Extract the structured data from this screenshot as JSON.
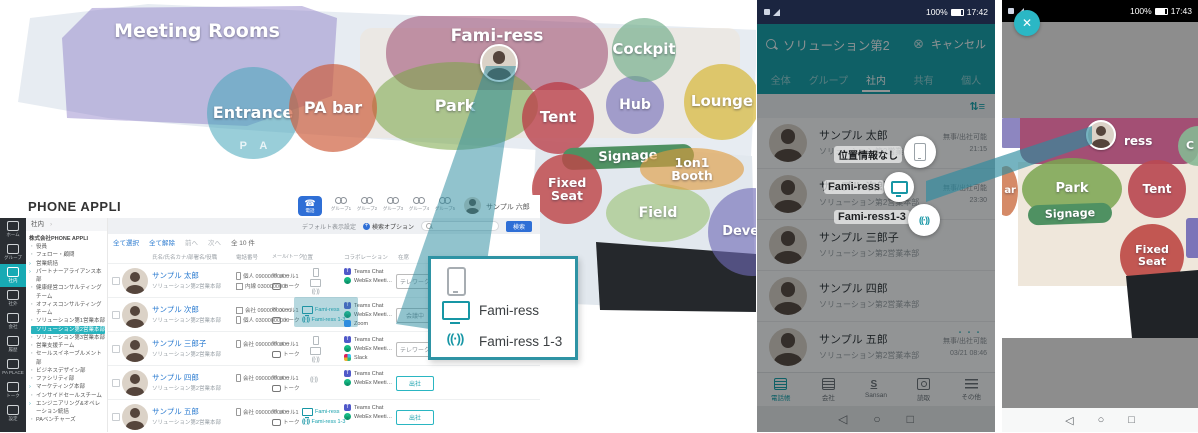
{
  "colors": {
    "teal": "#12a0a9",
    "beam": "#2d8fa3",
    "blue": "#2f6fd6"
  },
  "map": {
    "pa_sign": "P A",
    "zones": {
      "meeting_rooms": "Meeting Rooms",
      "entrance": "Entrance",
      "pa_bar": "PA bar",
      "fami_ress": "Fami-ress",
      "park": "Park",
      "tent": "Tent",
      "hub": "Hub",
      "cockpit": "Cockpit",
      "lounge": "Lounge",
      "signage": "Signage",
      "fixed_seat": "Fixed Seat",
      "field": "Field",
      "booth": "1on1 Booth",
      "develop": "Develop"
    }
  },
  "desktop": {
    "logo": "PHONE APPLI",
    "rail": {
      "home": "ホーム",
      "group": "グループ",
      "internal": "社内",
      "external": "社外",
      "company": "会社",
      "history": "履歴",
      "place": "PA PLACE",
      "talk": "トーク",
      "settings": "設定"
    },
    "header": {
      "phone_button": "電話",
      "groups": [
        "グループ1",
        "グループ2",
        "グループ3",
        "グループ4",
        "グループ5"
      ],
      "user": "サンプル 六郎"
    },
    "searchbar": {
      "default_display": "デフォルト表示設定",
      "search_option": "検索オプション",
      "search_button": "検索"
    },
    "toolbar": {
      "select_all": "全て選択",
      "clear_all": "全て解除",
      "prev": "前へ",
      "next": "次へ",
      "count": "全 10 件"
    },
    "breadcrumb": "社内",
    "tree": {
      "company": "株式会社PHONE APPLI",
      "items": [
        "役員",
        "フェロー・顧問",
        "営業統括",
        "パートナーアライアンス本部",
        "健康経営コンサルティングチーム",
        "オフィスコンサルティングチーム",
        "ソリューション第1営業本部",
        "ソリューション第2営業本部",
        "ソリューション第3営業本部",
        "営業支援チーム",
        "セールスイネーブルメント部",
        "ビジネスデザイン部",
        "ファシリティ部",
        "マーケティング本部",
        "インサイドセールスチーム",
        "エンジニアリング&オペレーション統括",
        "PAベンチャーズ",
        "Phone Appli Global"
      ]
    },
    "table": {
      "columns": [
        "氏名/氏名カナ/部署名/役職",
        "電話番号",
        "メール/トーク",
        "位置",
        "コラボレーション",
        "在席"
      ],
      "rows": [
        {
          "name": "サンプル 太郎",
          "dept": "ソリューション第2営業本部",
          "phone1": "個人 09000000000",
          "phone2": "内線 0300000000",
          "mail": "メール1",
          "talk": "トーク",
          "loc1": "",
          "loc2": "",
          "collab1": "Teams Chat",
          "collab2": "WebEx Meeti…",
          "collab3": "",
          "status": "テレワーク"
        },
        {
          "name": "サンプル 次郎",
          "dept": "ソリューション第2営業本部",
          "phone1": "会社 09000000000",
          "phone2": "個人 03000000000",
          "mail": "メール1",
          "talk": "トーク",
          "loc1": "Fami-ress",
          "loc2": "Fami-ress 1-3",
          "collab1": "Teams Chat",
          "collab2": "WebEx Meeti…",
          "collab3": "Zoom",
          "status": "会議中"
        },
        {
          "name": "サンプル 三郎子",
          "dept": "ソリューション第2営業本部",
          "phone1": "会社 09000000000",
          "phone2": "",
          "mail": "メール1",
          "talk": "トーク",
          "loc1": "",
          "loc2": "",
          "collab1": "Teams Chat",
          "collab2": "WebEx Meeti…",
          "collab3": "Slack",
          "status": "テレワーク"
        },
        {
          "name": "サンプル 四郎",
          "dept": "ソリューション第2営業本部",
          "phone1": "会社 09000000000",
          "phone2": "",
          "mail": "メール1",
          "talk": "トーク",
          "loc1": "",
          "loc2": "",
          "collab1": "Teams Chat",
          "collab2": "WebEx Meeti…",
          "collab3": "",
          "status": "出社"
        },
        {
          "name": "サンプル 五郎",
          "dept": "ソリューション第2営業本部",
          "phone1": "会社 09000000000",
          "phone2": "",
          "mail": "メール1",
          "talk": "トーク",
          "loc1": "Fami-ress",
          "loc2": "Fami-ress 1-3",
          "collab1": "Teams Chat",
          "collab2": "WebEx Meeti…",
          "collab3": "",
          "status": "出社"
        }
      ]
    },
    "callout": {
      "monitor_label": "Fami-ress",
      "beacon_label": "Fami-ress 1-3"
    }
  },
  "phone": {
    "statusbar": {
      "battery": "100%",
      "time": "17:42"
    },
    "search": {
      "query": "ソリューション第2",
      "cancel": "キャンセル"
    },
    "tabs": [
      "全体",
      "グループ",
      "社内",
      "共有",
      "個人"
    ],
    "contacts": [
      {
        "name": "サンプル 太郎",
        "dept": "ソリューション第2営業本部",
        "status": "無事/出社可能",
        "time": "21:15"
      },
      {
        "name": "サンプル 次郎",
        "dept": "ソリューション第2営業本部",
        "status": "無事/出社可能",
        "time": "23:30"
      },
      {
        "name": "サンプル 三郎子",
        "dept": "ソリューション第2営業本部",
        "status": "",
        "time": ""
      },
      {
        "name": "サンプル 四郎",
        "dept": "ソリューション第2営業本部",
        "status": "",
        "time": ""
      },
      {
        "name": "サンプル 五郎",
        "dept": "ソリューション第2営業本部",
        "status": "無事/出社可能",
        "time": "03/21 08:46",
        "more": "・・・"
      }
    ],
    "overlay_labels": {
      "no_location": "位置情報なし",
      "monitor": "Fami-ress",
      "beacon": "Fami-ress1-3"
    },
    "nav": [
      "電話帳",
      "会社",
      "Sansan",
      "読取",
      "その他"
    ]
  },
  "phone2": {
    "statusbar": {
      "battery": "100%",
      "time": "17:43"
    },
    "zones": {
      "ress": "ress",
      "cockpit": "C",
      "park": "Park",
      "tent": "Tent",
      "signage": "Signage",
      "fixed_seat": "Fixed Seat",
      "pa_bar": "ar"
    }
  }
}
